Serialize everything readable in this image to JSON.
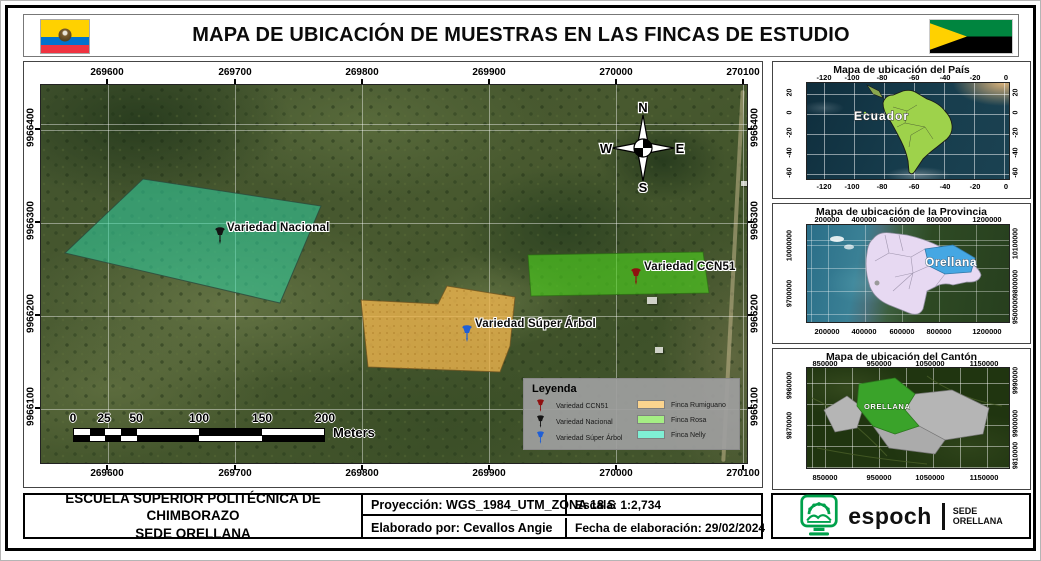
{
  "header": {
    "title": "MAPA DE UBICACIÓN DE MUESTRAS EN LAS FINCAS DE ESTUDIO"
  },
  "main_map": {
    "x_ticks": [
      "269600",
      "269700",
      "269800",
      "269900",
      "270000",
      "270100"
    ],
    "y_ticks": [
      "9966400",
      "9966300",
      "9966200",
      "9966100"
    ],
    "compass": {
      "n": "N",
      "w": "W",
      "e": "E",
      "s": "S"
    },
    "features": {
      "nacional": {
        "label": "Variedad Nacional",
        "pin_color": "#141414"
      },
      "ccn51": {
        "label": "Variedad CCN51",
        "pin_color": "#8f1010"
      },
      "super_arbol": {
        "label": "Variedad Súper Árbol",
        "pin_color": "#1f5fd6"
      }
    },
    "scale_bar": {
      "labels": [
        "0",
        "25",
        "50",
        "100",
        "150",
        "200"
      ],
      "unit": "Meters"
    },
    "legend": {
      "title": "Leyenda",
      "point_items": [
        {
          "label": "Variedad CCN51",
          "color": "#8f1010"
        },
        {
          "label": "Variedad Nacional",
          "color": "#141414"
        },
        {
          "label": "Variedad Súper Árbol",
          "color": "#1f5fd6"
        }
      ],
      "area_items": [
        {
          "label": "Finca Rumiguano",
          "color": "#fbd48e"
        },
        {
          "label": "Finca Rosa",
          "color": "#a5ee84"
        },
        {
          "label": "Finca Nelly",
          "color": "#7fefd4"
        }
      ]
    }
  },
  "insets": {
    "country": {
      "title": "Mapa de ubicación del País",
      "map_label": "Ecuador",
      "x_ticks": [
        "-120",
        "-100",
        "-80",
        "-60",
        "-40",
        "-20",
        "0"
      ],
      "y_ticks": [
        "20",
        "0",
        "-20",
        "-40",
        "-60"
      ]
    },
    "province": {
      "title": "Mapa de ubicación de la Provincia",
      "map_label": "Orellana",
      "x_ticks": [
        "200000",
        "400000",
        "600000",
        "800000",
        "1200000"
      ],
      "y_ticks_left": [
        "10000000",
        "9700000"
      ],
      "y_ticks_right": [
        "10100000",
        "9800000",
        "9500000"
      ]
    },
    "canton": {
      "title": "Mapa de ubicación del Cantón",
      "map_label": "ORELLANA",
      "x_ticks": [
        "850000",
        "950000",
        "1050000",
        "1150000"
      ],
      "y_ticks_left": [
        "9960000",
        "9870000"
      ],
      "y_ticks_right": [
        "9990000",
        "9900000",
        "9810000"
      ]
    }
  },
  "footer": {
    "institution_line1": "ESCUELA SUPERIOR POLITÉCNICA DE CHIMBORAZO",
    "institution_line2": "SEDE ORELLANA",
    "projection": "Proyección: WGS_1984_UTM_ZONA 18 S",
    "scale": "Escala: 1:2,734",
    "author": "Elaborado por: Cevallos Angie",
    "date": "Fecha de elaboración: 29/02/2024",
    "logo": {
      "wordmark": "espoch",
      "sub_line1": "SEDE",
      "sub_line2": "ORELLANA"
    }
  }
}
